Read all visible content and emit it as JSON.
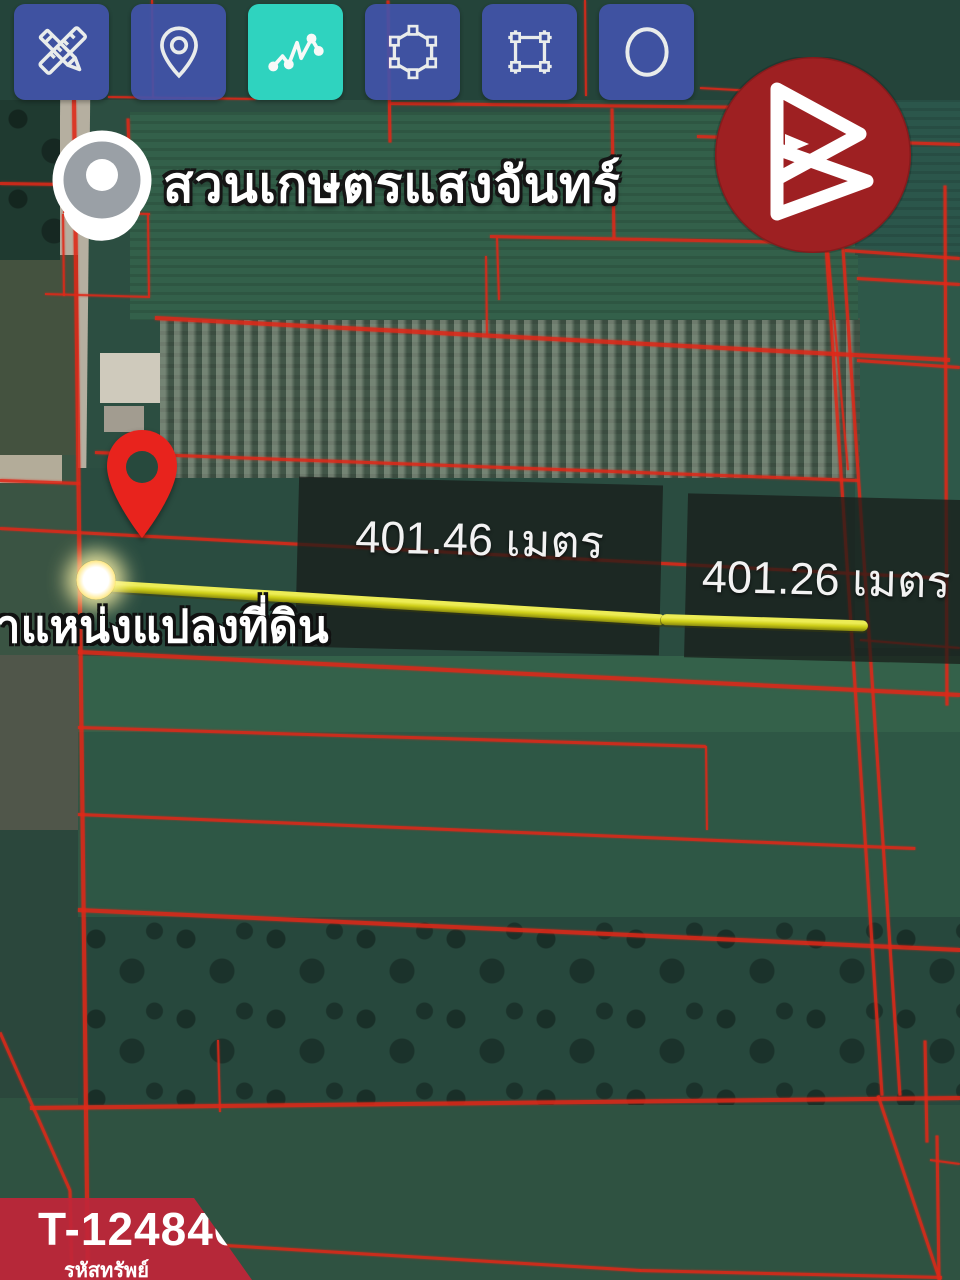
{
  "app": {
    "toolbar": {
      "tools": [
        {
          "id": "draw-measure",
          "icon": "ruler-pencil-icon",
          "active": false
        },
        {
          "id": "drop-pin",
          "icon": "map-pin-icon",
          "active": false
        },
        {
          "id": "measure-polyline",
          "icon": "polyline-zigzag-icon",
          "active": true
        },
        {
          "id": "draw-polygon",
          "icon": "polygon-icon",
          "active": false
        },
        {
          "id": "draw-rectangle",
          "icon": "rectangle-icon",
          "active": false
        },
        {
          "id": "draw-circle",
          "icon": "circle-icon",
          "active": false
        }
      ],
      "colors": {
        "button": "#4254ad",
        "active": "#30d8c4",
        "icon": "#ffffff"
      }
    },
    "watermark": {
      "icon": "triangle-b-logo-icon",
      "color": "#9e2022"
    }
  },
  "map": {
    "place_name": "สวนเกษตรแสงจันทร์",
    "pin_caption": "ตำแหน่งแปลงที่ดิน",
    "measurement_labels": [
      "401.46 เมตร",
      "401.26 เมตร"
    ],
    "colors": {
      "measure_line": "#cfcf18",
      "parcel_boundary": "#e02818"
    }
  },
  "property_badge": {
    "code": "T-124846",
    "caption": "รหัสทรัพย์",
    "color": "#c02539"
  }
}
